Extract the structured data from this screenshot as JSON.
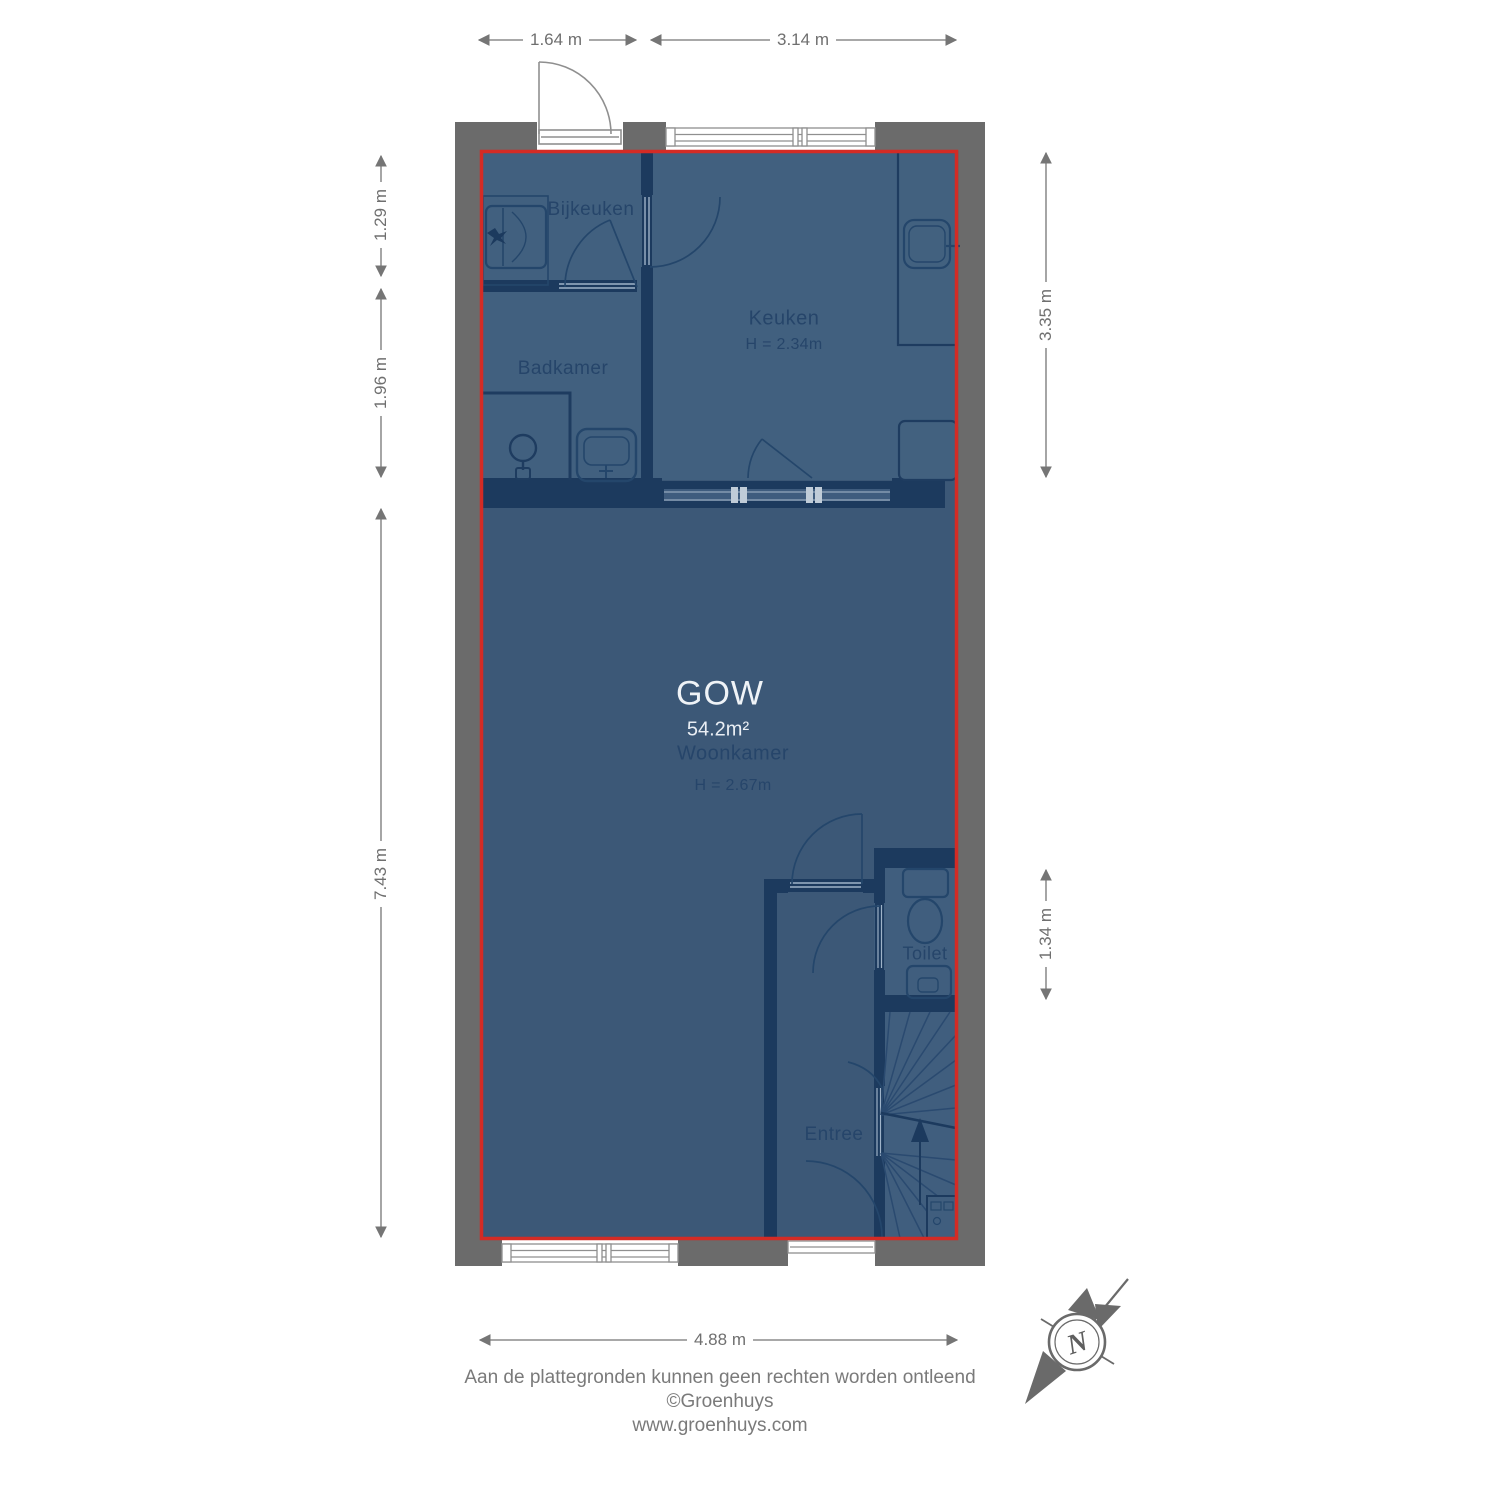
{
  "floorplan": {
    "rooms": {
      "bijkeuken": {
        "label": "Bijkeuken"
      },
      "badkamer": {
        "label": "Badkamer"
      },
      "keuken": {
        "label": "Keuken",
        "height": "H = 2.34m"
      },
      "woonkamer": {
        "label": "Woonkamer",
        "height": "H = 2.67m"
      },
      "toilet": {
        "label": "Toilet"
      },
      "entree": {
        "label": "Entree"
      }
    },
    "area_badge": {
      "code": "GOW",
      "area": "54.2m²"
    },
    "dimensions": {
      "top_left": "1.64 m",
      "top_right": "3.14 m",
      "left_upper": "1.29 m",
      "left_middle": "1.96 m",
      "left_lower": "7.43 m",
      "right_upper": "3.35 m",
      "right_lower": "1.34 m",
      "bottom": "4.88 m"
    },
    "compass": {
      "north_label": "N"
    },
    "colors": {
      "outline_red": "#d32b25",
      "wall_gray": "#6b6b6b",
      "floor_blue": "#3c5877",
      "floor_blue_light": "#41607f",
      "interior_wall_navy": "#1c3a5e",
      "annotation_gray": "#6f6f6f"
    }
  },
  "footer": {
    "disclaimer": "Aan de plattegronden kunnen geen rechten worden ontleend",
    "copyright": "©Groenhuys",
    "website": "www.groenhuys.com"
  }
}
